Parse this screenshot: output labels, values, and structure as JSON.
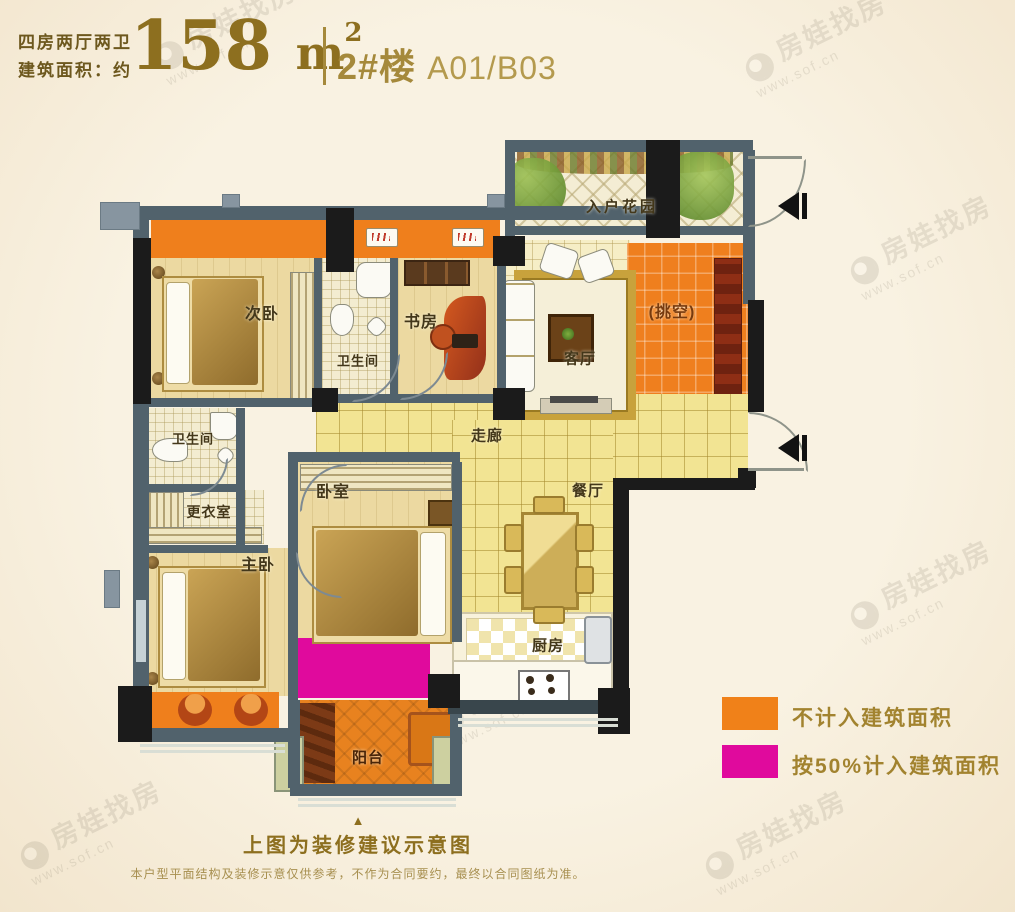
{
  "header": {
    "layout_type": "四房两厅两卫",
    "area_prefix": "建筑面积：约",
    "area_value": "158",
    "area_unit": "m",
    "area_exponent": "2",
    "building_label": "2#楼",
    "unit_label": "A01/B03"
  },
  "rooms": {
    "entry_garden": "入户花园",
    "second_bedroom": "次卧",
    "bathroom_top": "卫生间",
    "study": "书房",
    "living_room": "客厅",
    "void_area": "(挑空)",
    "corridor": "走廊",
    "bathroom_left": "卫生间",
    "dressing_room": "更衣室",
    "master_bedroom": "主卧",
    "bedroom": "卧室",
    "dining_room": "餐厅",
    "kitchen": "厨房",
    "balcony": "阳台"
  },
  "legend": [
    {
      "label": "不计入建筑面积",
      "color": "#f08119"
    },
    {
      "label": "按50%计入建筑面积",
      "color": "#e00a9d"
    }
  ],
  "footer": {
    "pointer": "▲",
    "title": "上图为装修建议示意图",
    "disclaimer": "本户型平面结构及装修示意仅供参考，不作为合同要约，最终以合同图纸为准。"
  },
  "watermark": {
    "brand": "房娃找房",
    "url": "www.sof.cn"
  },
  "colors": {
    "accent_gold": "#8d6f1f",
    "orange_zone": "#f08119",
    "magenta_zone": "#e00a9d",
    "wall_gray": "#51626c",
    "wall_black": "#1b1b1b",
    "background": "#f8f1e1"
  }
}
